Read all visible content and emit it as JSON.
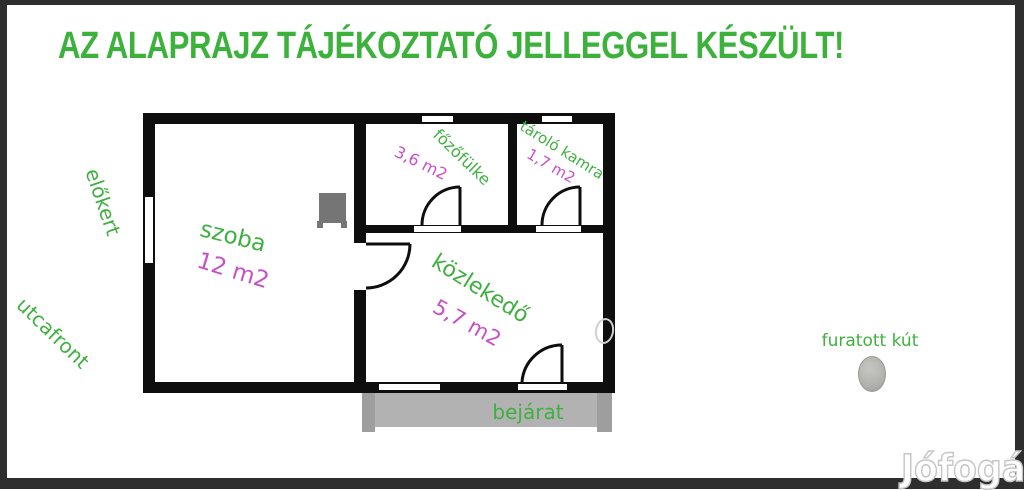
{
  "title": "AZ ALAPRAJZ TÁJÉKOZTATÓ JELLEGGEL KÉSZÜLT!",
  "rooms": [
    {
      "name": "szoba",
      "area": "12 m2"
    },
    {
      "name": "főzőfülke",
      "area": "3,6 m2"
    },
    {
      "name": "tároló kamra",
      "area": "1,7 m2"
    },
    {
      "name": "közlekedő",
      "area": "5,7 m2"
    }
  ],
  "outside_labels": {
    "front_garden": "előkert",
    "street_front": "utcafront",
    "entrance": "bejárat",
    "well": "furatott kút"
  },
  "watermark": "Jófogás",
  "colors": {
    "title_green": "#3cb23c",
    "label_green": "#3fb03f",
    "area_magenta": "#c750c7",
    "wall_black": "#0e0e0e",
    "porch_gray": "#b2b2b2",
    "frame_dark": "#2e2e2e"
  }
}
